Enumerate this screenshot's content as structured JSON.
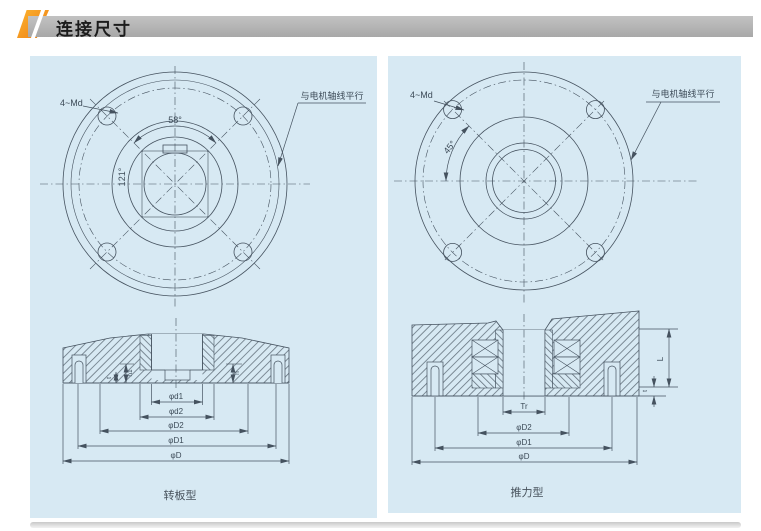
{
  "header": {
    "title": "连接尺寸"
  },
  "left": {
    "caption": "转板型",
    "bolt_label": "4~Md",
    "angle_top": "58°",
    "angle_left": "121°",
    "note": "与电机轴线平行",
    "dim_d1": "φd1",
    "dim_d2": "φd2",
    "dim_D2": "φD2",
    "dim_D1": "φD1",
    "dim_D": "φD",
    "dim_t": "t",
    "dim_h1": "h1",
    "dim_h": "h"
  },
  "right": {
    "caption": "推力型",
    "bolt_label": "4~Md",
    "angle": "45°",
    "note": "与电机轴线平行",
    "dim_Tr": "Tr",
    "dim_D2": "φD2",
    "dim_D1": "φD1",
    "dim_D": "φD",
    "dim_L": "L",
    "dim_t": "t"
  },
  "colors": {
    "accent_orange": "#f2901d",
    "panel_blue": "#d7e9f3",
    "line": "#45525f",
    "header_bar_gray": "#b3b3b3"
  }
}
